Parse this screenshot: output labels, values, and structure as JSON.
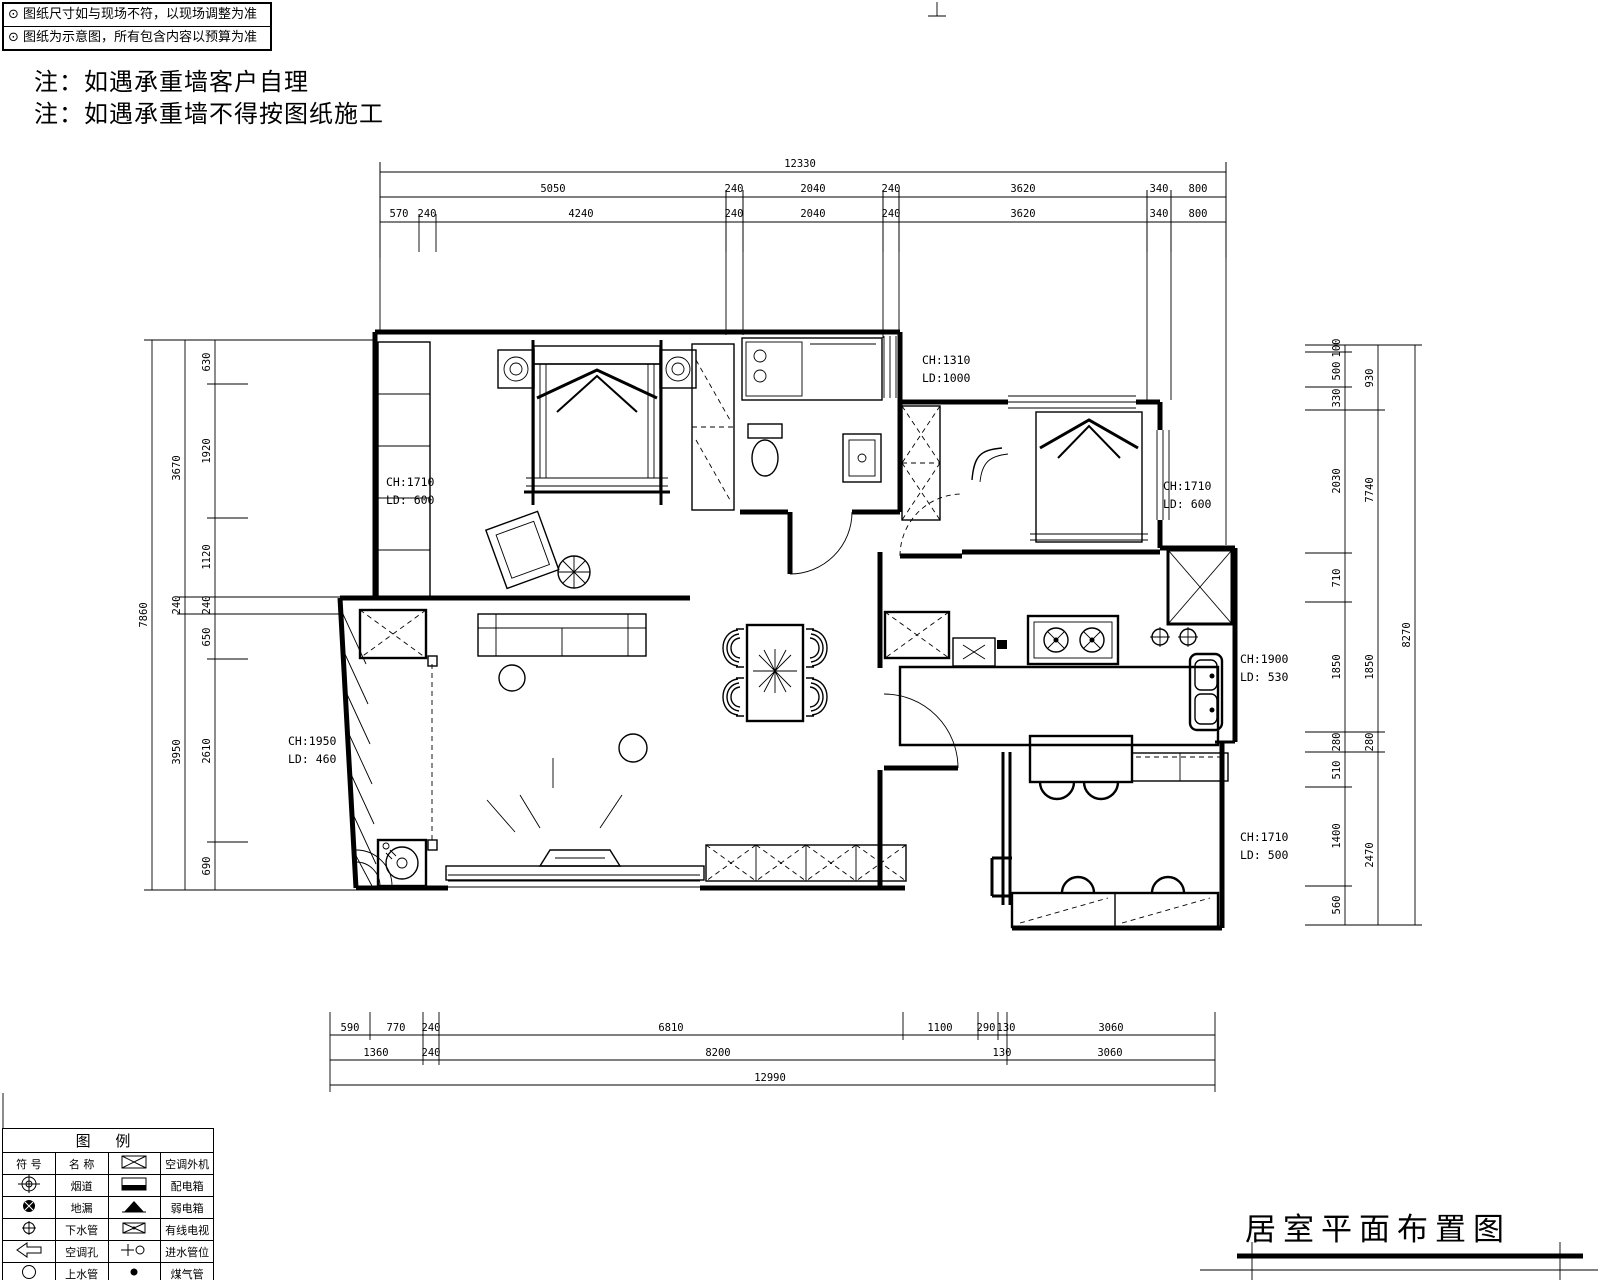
{
  "sheet": {
    "disclaimer": {
      "line1": "⊙ 图纸尺寸如与现场不符，以现场调整为准",
      "line2": "⊙ 图纸为示意图，所有包含内容以预算为准"
    },
    "notes": [
      "注：如遇承重墙客户自理",
      "注：如遇承重墙不得按图纸施工"
    ],
    "title": "居室平面布置图"
  },
  "dimensions": {
    "top": {
      "row1": [
        "12330"
      ],
      "row2": [
        "5050",
        "240",
        "2040",
        "240",
        "3620",
        "340",
        "800"
      ],
      "row3": [
        "570",
        "240",
        "4240",
        "240",
        "2040",
        "240",
        "3620",
        "340",
        "800"
      ]
    },
    "bottom": {
      "row1": [
        "590",
        "770",
        "240",
        "6810",
        "1100",
        "290",
        "130",
        "3060"
      ],
      "row2": [
        "1360",
        "240",
        "8200",
        "130",
        "3060"
      ],
      "row3": [
        "12990"
      ]
    },
    "left": {
      "inner": [
        "630",
        "1920",
        "1120",
        "240",
        "650",
        "2610",
        "690"
      ],
      "middle": [
        "3670",
        "240",
        "3950"
      ],
      "outer": [
        "7860"
      ]
    },
    "right": {
      "inner": [
        "100",
        "500",
        "330",
        "2030",
        "710",
        "1850",
        "280",
        "510",
        "1400",
        "560"
      ],
      "middle": [
        "930",
        "7740",
        "1850",
        "280",
        "2470"
      ],
      "outer": [
        "8270"
      ]
    }
  },
  "annotations": [
    {
      "ch": "CH:1310",
      "ld": "LD:1000"
    },
    {
      "ch": "CH:1710",
      "ld": "LD: 600"
    },
    {
      "ch": "CH:1710",
      "ld": "LD: 600"
    },
    {
      "ch": "CH:1900",
      "ld": "LD: 530"
    },
    {
      "ch": "CH:1950",
      "ld": "LD: 460"
    },
    {
      "ch": "CH:1710",
      "ld": "LD: 500"
    }
  ],
  "legend": {
    "title": "图  例",
    "header": {
      "symbol": "符 号",
      "name": "名 称",
      "first_right": "空调外机"
    },
    "rows": [
      {
        "l": "烟道",
        "r": "配电箱"
      },
      {
        "l": "地漏",
        "r": "弱电箱"
      },
      {
        "l": "下水管",
        "r": "有线电视"
      },
      {
        "l": "空调孔",
        "r": "进水管位"
      },
      {
        "l": "上水管",
        "r": "煤气管"
      }
    ]
  }
}
